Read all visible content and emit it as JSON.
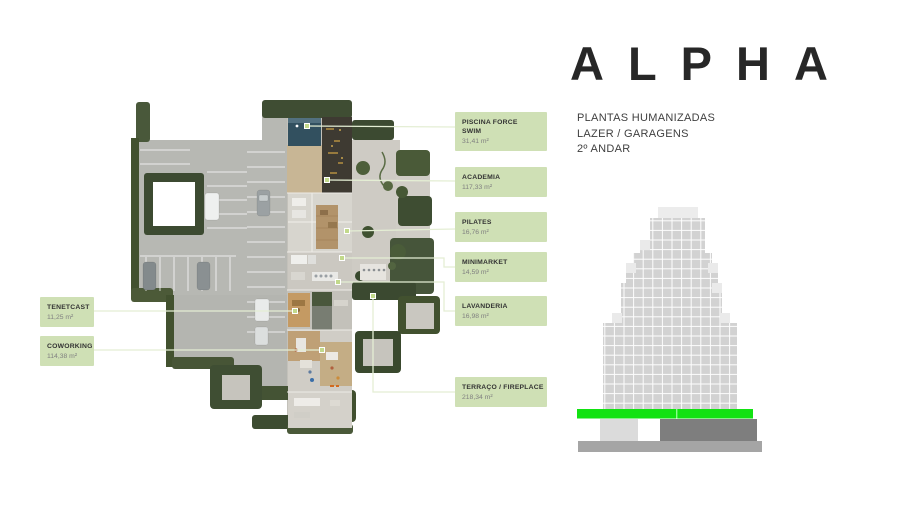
{
  "brand": {
    "logo": "ALPHA",
    "subtitle_line1": "PLANTAS HUMANIZADAS",
    "subtitle_line2": "LAZER / GARAGENS",
    "subtitle_line3": "2º ANDAR"
  },
  "labels": {
    "piscina": {
      "title": "PISCINA FORCE SWIM",
      "area": "31,41 m²"
    },
    "academia": {
      "title": "ACADEMIA",
      "area": "117,33 m²"
    },
    "pilates": {
      "title": "PILATES",
      "area": "16,76 m²"
    },
    "minimarket": {
      "title": "MINIMARKET",
      "area": "14,59 m²"
    },
    "lavanderia": {
      "title": "LAVANDERIA",
      "area": "16,98 m²"
    },
    "terraco": {
      "title": "TERRAÇO / FIREPLACE",
      "area": "218,34 m²"
    },
    "tenetcast": {
      "title": "TENETCAST",
      "area": "11,25 m²"
    },
    "coworking": {
      "title": "COWORKING",
      "area": "114,38 m²"
    }
  },
  "colors": {
    "label_background": "#cfe0b5",
    "highlighted_floor_green": "#12e212",
    "logo_text": "#272727"
  }
}
